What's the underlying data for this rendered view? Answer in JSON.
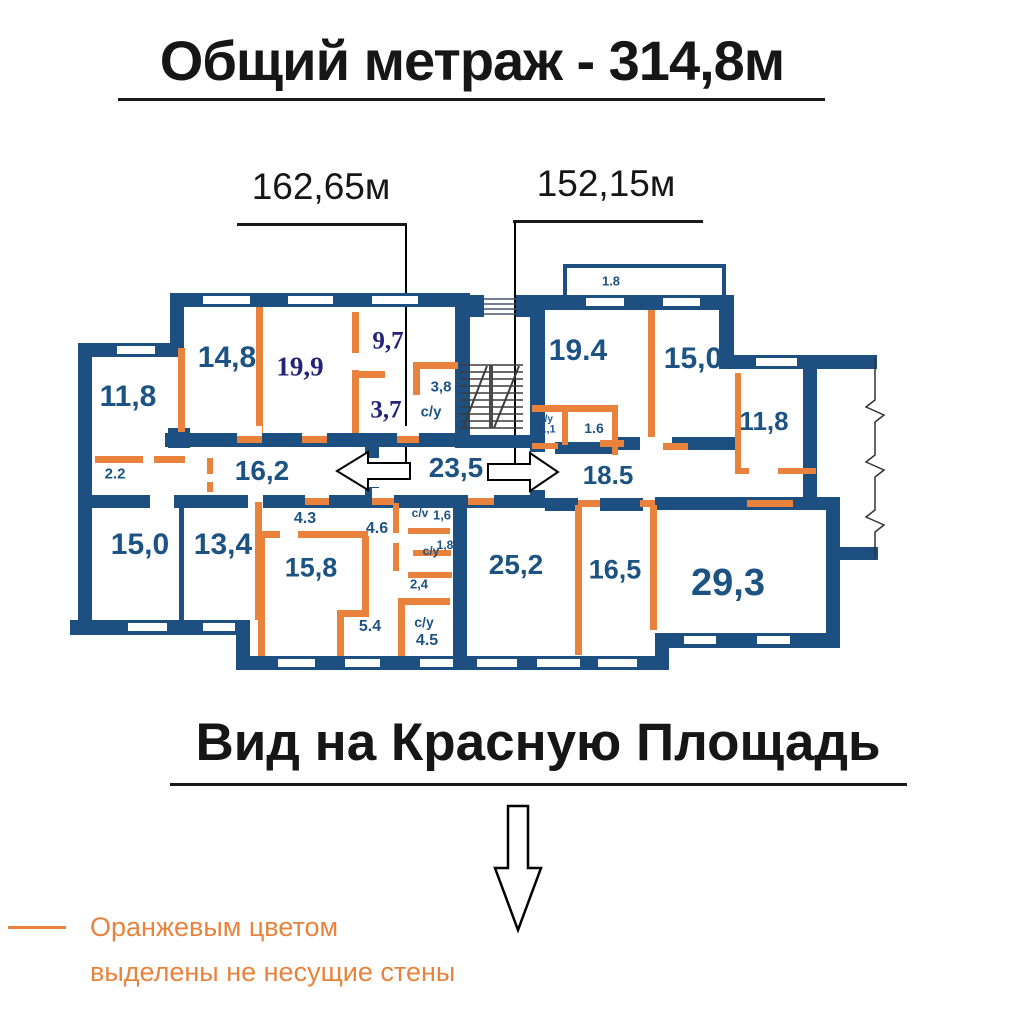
{
  "header": {
    "title": "Общий метраж - 314,8м"
  },
  "dimensions": {
    "left_wing_label": "162,65м",
    "right_wing_label": "152,15м"
  },
  "rooms": [
    {
      "name": "room-11-8-left",
      "area": "11,8"
    },
    {
      "name": "room-14-8",
      "area": "14,8"
    },
    {
      "name": "room-19-9",
      "area": "19,9"
    },
    {
      "name": "room-9-7",
      "area": "9,7"
    },
    {
      "name": "room-3-7",
      "area": "3,7"
    },
    {
      "name": "room-3-8",
      "area": "3,8"
    },
    {
      "name": "bathroom-top-left",
      "area": "с/у"
    },
    {
      "name": "corridor-16-2",
      "area": "16,2"
    },
    {
      "name": "storage-2-2",
      "area": "2.2"
    },
    {
      "name": "corridor-23-5",
      "area": "23,5"
    },
    {
      "name": "room-15-0-left",
      "area": "15,0"
    },
    {
      "name": "room-13-4",
      "area": "13,4"
    },
    {
      "name": "hall-4-3",
      "area": "4.3"
    },
    {
      "name": "room-15-8",
      "area": "15,8"
    },
    {
      "name": "hall-4-6",
      "area": "4.6"
    },
    {
      "name": "bathroom-cv",
      "area": "с/v"
    },
    {
      "name": "bathroom-1-6-left",
      "area": "1,6"
    },
    {
      "name": "bathroom-mid-left",
      "area": "с/у"
    },
    {
      "name": "bathroom-1-8",
      "area": "1,8"
    },
    {
      "name": "hall-2-4",
      "area": "2,4"
    },
    {
      "name": "hall-5-4",
      "area": "5.4"
    },
    {
      "name": "bathroom-bottom-left",
      "area": "с/у"
    },
    {
      "name": "bathroom-4-5",
      "area": "4.5"
    },
    {
      "name": "room-25-2",
      "area": "25,2"
    },
    {
      "name": "balcony-1-8",
      "area": "1.8"
    },
    {
      "name": "room-19-4",
      "area": "19.4"
    },
    {
      "name": "room-15-0-right",
      "area": "15,0"
    },
    {
      "name": "room-11-8-right",
      "area": "11,8"
    },
    {
      "name": "bathroom-right",
      "area": "с/у"
    },
    {
      "name": "bathroom-1-1",
      "area": "1,1"
    },
    {
      "name": "bathroom-1-6-right",
      "area": "1.6"
    },
    {
      "name": "corridor-18-5",
      "area": "18.5"
    },
    {
      "name": "room-16-5",
      "area": "16,5"
    },
    {
      "name": "room-29-3",
      "area": "29,3"
    }
  ],
  "footer": {
    "title": "Вид на Красную Площадь"
  },
  "legend": {
    "line1": "Оранжевым цветом",
    "line2": "выделены не несущие стены"
  },
  "colors": {
    "load_bearing_wall": "#1d4f80",
    "non_bearing_wall": "#e8823c",
    "room_label": "#1d5383",
    "serif_label": "#232379",
    "legend_text": "#e8833d",
    "title_text": "#161616"
  }
}
